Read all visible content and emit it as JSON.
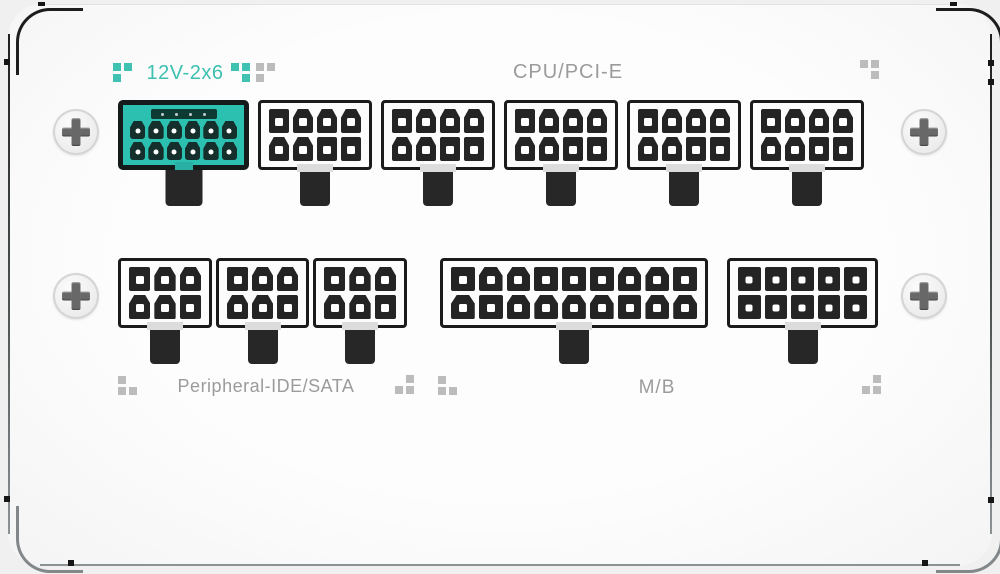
{
  "labels": {
    "twelve_v2x6": "12V-2x6",
    "cpu_pcie": "CPU/PCI-E",
    "peripheral": "Peripheral-IDE/SATA",
    "motherboard": "M/B"
  },
  "colors": {
    "teal_accent": "#3CC0B0",
    "teal_connector": "#2CC0B1",
    "label_gray": "#9B9B9B",
    "connector_black": "#1B1B1B",
    "panel_white": "#FCFCFC",
    "motif_gray": "#BCBCBC"
  },
  "connectors": [
    {
      "key": "12v2x6",
      "name": "12V-2x6 12-pin socket",
      "style": "teal",
      "cols": 6,
      "rows": 2,
      "pins": 12,
      "hole": "round",
      "sense_pins": 4,
      "shapes": [
        "d",
        "d",
        "d",
        "d",
        "d",
        "d",
        "d",
        "d",
        "d",
        "d",
        "d",
        "d"
      ]
    },
    {
      "key": "cpu1",
      "name": "CPU/PCI-E 8-pin socket",
      "style": "white",
      "cols": 4,
      "rows": 2,
      "pins": 8,
      "hole": "square",
      "shapes": [
        "s",
        "d",
        "d",
        "d",
        "d",
        "d",
        "s",
        "s"
      ]
    },
    {
      "key": "cpu2",
      "name": "CPU/PCI-E 8-pin socket",
      "style": "white",
      "cols": 4,
      "rows": 2,
      "pins": 8,
      "hole": "square",
      "shapes": [
        "s",
        "d",
        "d",
        "d",
        "d",
        "d",
        "s",
        "s"
      ]
    },
    {
      "key": "cpu3",
      "name": "CPU/PCI-E 8-pin socket",
      "style": "white",
      "cols": 4,
      "rows": 2,
      "pins": 8,
      "hole": "square",
      "shapes": [
        "s",
        "d",
        "d",
        "d",
        "d",
        "d",
        "s",
        "s"
      ]
    },
    {
      "key": "cpu4",
      "name": "CPU/PCI-E 8-pin socket",
      "style": "white",
      "cols": 4,
      "rows": 2,
      "pins": 8,
      "hole": "square",
      "shapes": [
        "s",
        "d",
        "d",
        "d",
        "d",
        "d",
        "s",
        "s"
      ]
    },
    {
      "key": "cpu5",
      "name": "CPU/PCI-E 8-pin socket",
      "style": "white",
      "cols": 4,
      "rows": 2,
      "pins": 8,
      "hole": "square",
      "shapes": [
        "s",
        "d",
        "d",
        "d",
        "d",
        "d",
        "s",
        "s"
      ]
    },
    {
      "key": "per1",
      "name": "Peripheral 6-pin socket",
      "style": "white",
      "cols": 3,
      "rows": 2,
      "pins": 6,
      "hole": "square",
      "shapes": [
        "s",
        "d",
        "d",
        "d",
        "d",
        "s"
      ]
    },
    {
      "key": "per2",
      "name": "Peripheral 6-pin socket",
      "style": "white",
      "cols": 3,
      "rows": 2,
      "pins": 6,
      "hole": "square",
      "shapes": [
        "s",
        "d",
        "d",
        "d",
        "d",
        "s"
      ]
    },
    {
      "key": "per3",
      "name": "Peripheral 6-pin socket",
      "style": "white",
      "cols": 3,
      "rows": 2,
      "pins": 6,
      "hole": "square",
      "shapes": [
        "s",
        "d",
        "d",
        "d",
        "d",
        "s"
      ]
    },
    {
      "key": "mb",
      "name": "M/B 18-pin socket",
      "style": "white",
      "cols": 9,
      "rows": 2,
      "pins": 18,
      "hole": "square",
      "shapes": [
        "s",
        "d",
        "d",
        "s",
        "s",
        "s",
        "d",
        "d",
        "s",
        "d",
        "s",
        "d",
        "d",
        "d",
        "d",
        "s",
        "d",
        "d"
      ]
    },
    {
      "key": "aux",
      "name": "10-pin socket",
      "style": "white",
      "cols": 5,
      "rows": 2,
      "pins": 10,
      "hole": "small",
      "shapes": [
        "s",
        "s",
        "s",
        "s",
        "s",
        "s",
        "s",
        "s",
        "s",
        "s"
      ]
    }
  ],
  "motifs": [
    {
      "key": "m-12v-left",
      "color": "#3FC2B2",
      "cells": [
        1,
        1,
        1,
        0
      ]
    },
    {
      "key": "m-12v-right-teal",
      "color": "#3FC2B2",
      "cells": [
        1,
        1,
        0,
        1
      ]
    },
    {
      "key": "m-12v-right-gray",
      "color": "#BCBCBC",
      "cells": [
        1,
        1,
        1,
        0
      ]
    },
    {
      "key": "m-top-right",
      "color": "#BCBCBC",
      "cells": [
        1,
        1,
        0,
        1
      ]
    },
    {
      "key": "m-peripheral-left",
      "color": "#BCBCBC",
      "cells": [
        1,
        0,
        1,
        1
      ]
    },
    {
      "key": "m-peripheral-right",
      "color": "#BCBCBC",
      "cells": [
        0,
        1,
        1,
        1
      ]
    },
    {
      "key": "m-mb-left",
      "color": "#BCBCBC",
      "cells": [
        1,
        0,
        1,
        1
      ]
    },
    {
      "key": "m-mb-right",
      "color": "#BCBCBC",
      "cells": [
        0,
        1,
        1,
        1
      ]
    }
  ],
  "screws": {
    "count": 4,
    "type": "phillips"
  }
}
